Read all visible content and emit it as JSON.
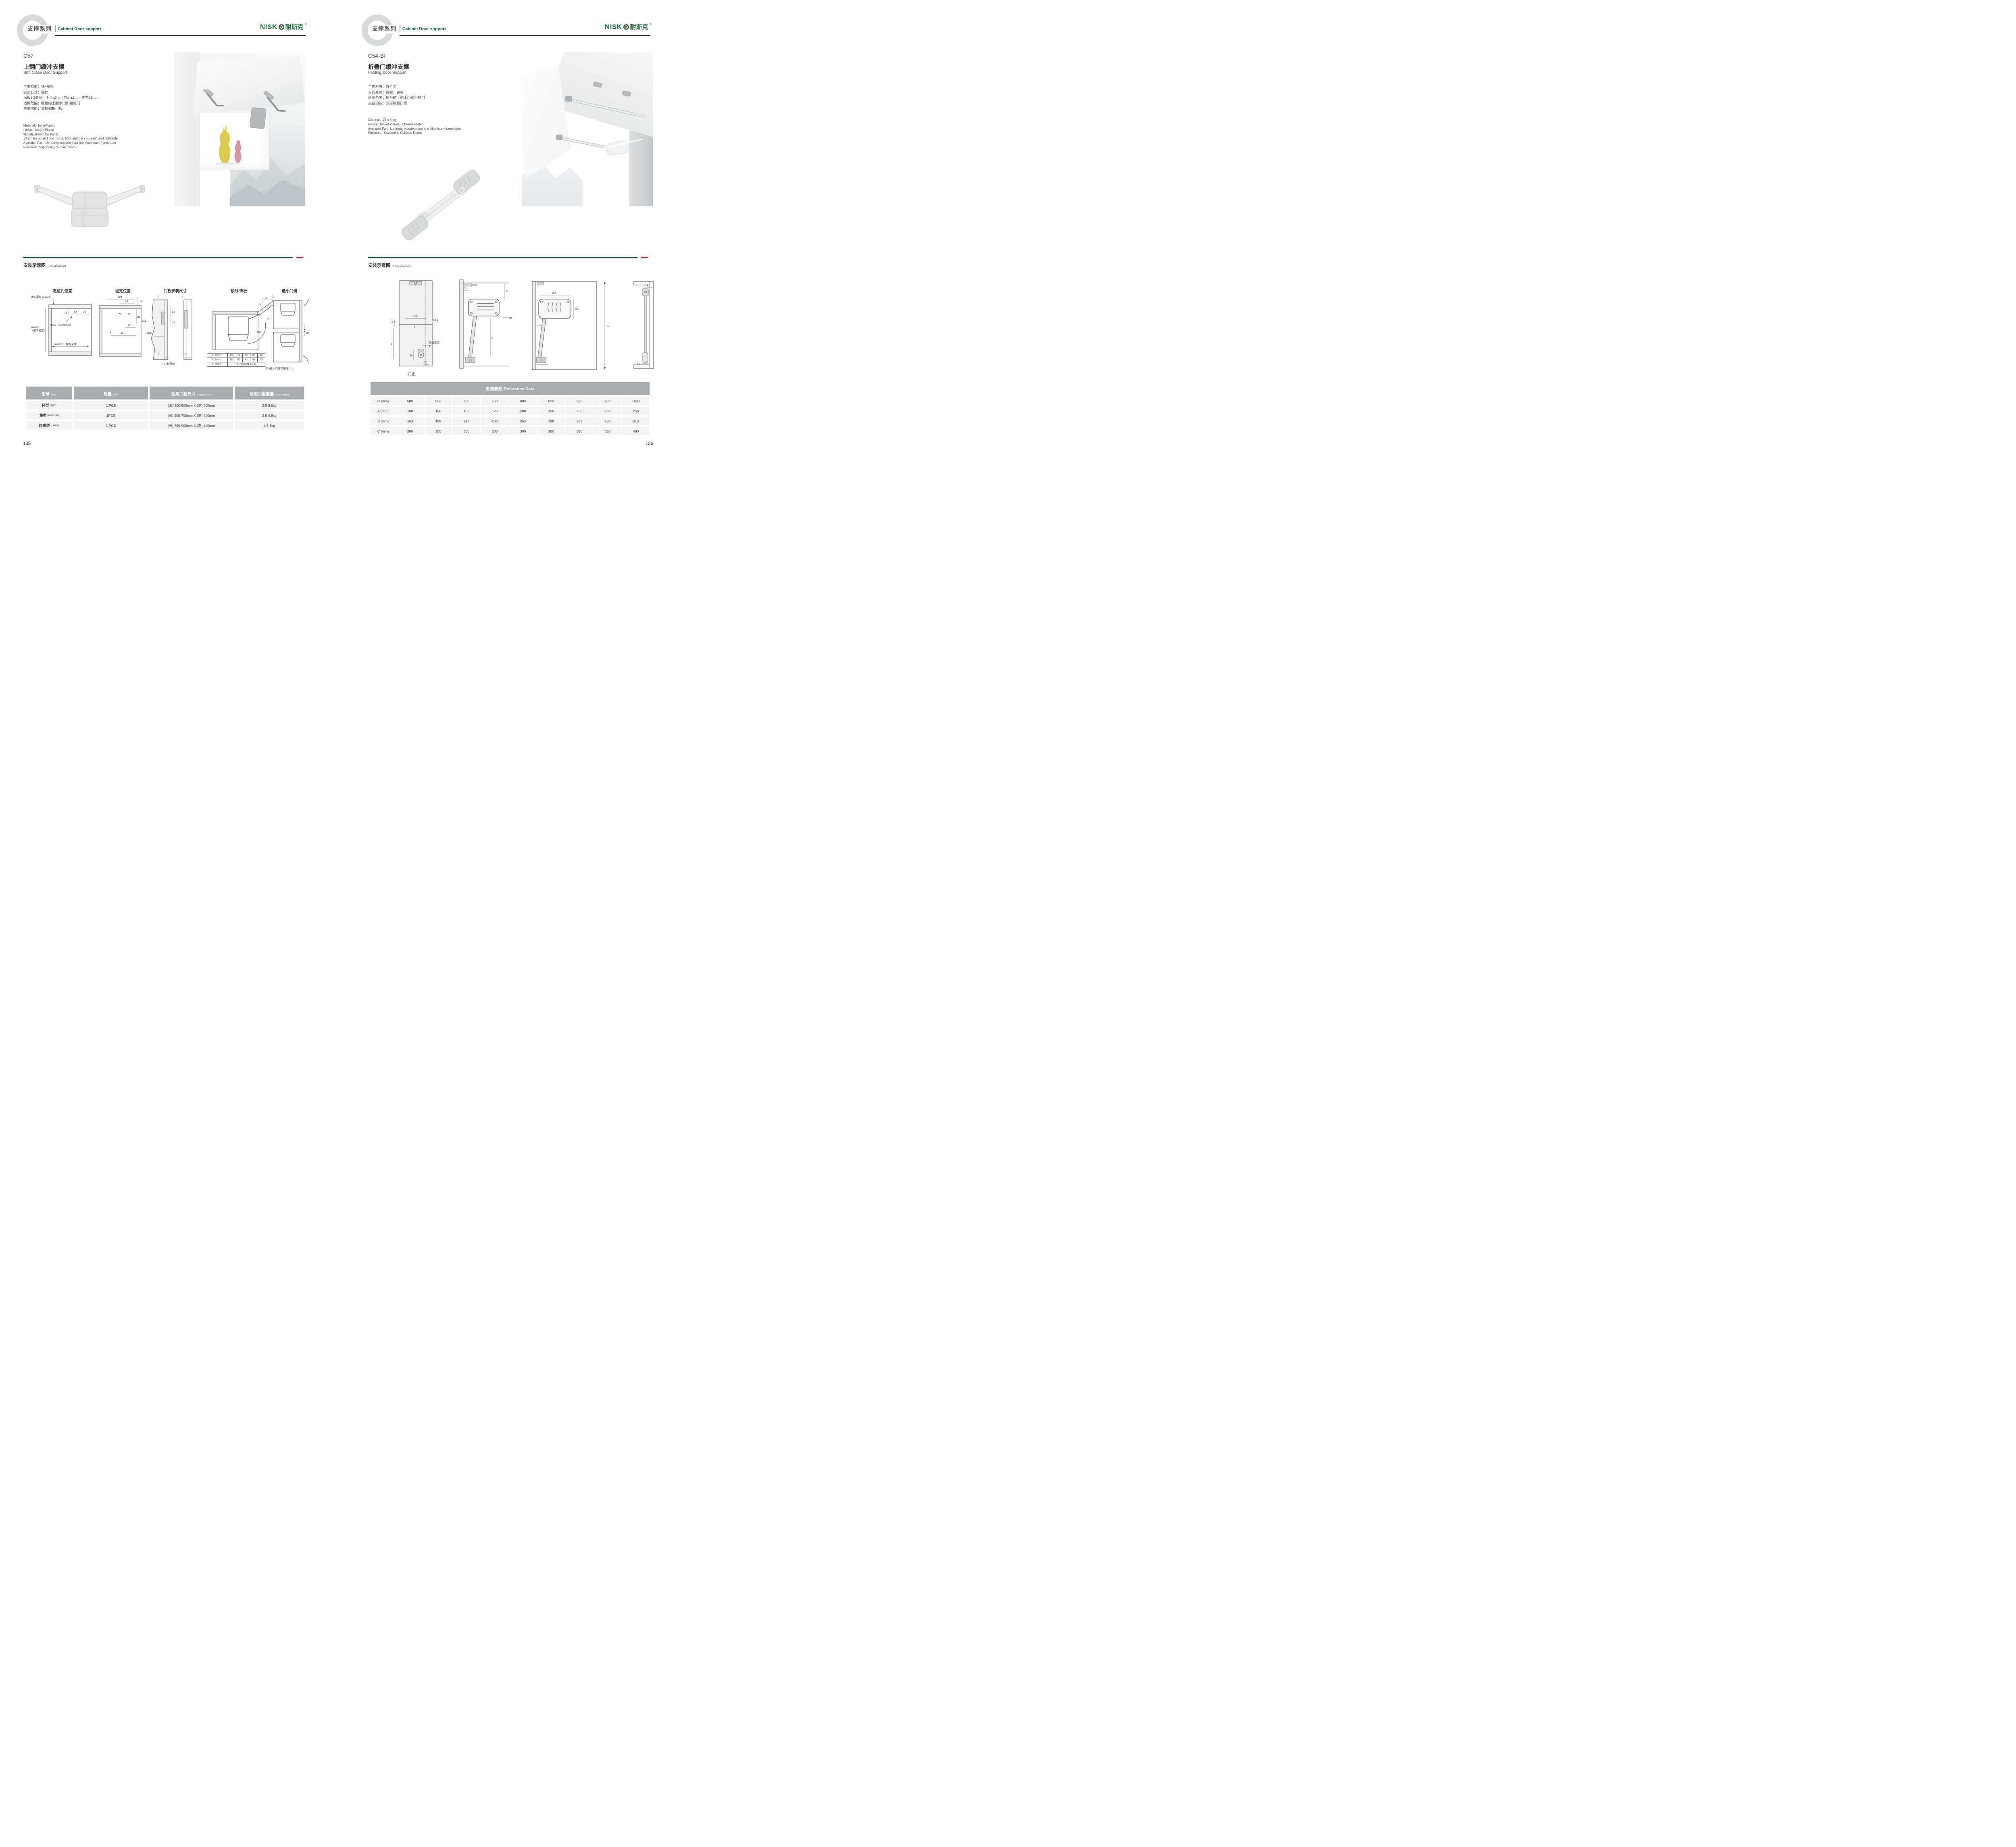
{
  "theme": {
    "brand_green": "#1a6b3f",
    "divider_green": "#17523b",
    "accent_red": "#c2242e",
    "table_header_gray": "#a8abad",
    "row_gray": "#f3f3f4"
  },
  "header": {
    "series_zh": "支撑系列",
    "series_en": "Cabinet Door support",
    "logo_latin": "NISK",
    "logo_zh": "耐斯克",
    "logo_reg": "®"
  },
  "install_heading": {
    "zh": "安装示意图",
    "en": "Installation"
  },
  "pages": [
    {
      "page_number": "135",
      "product": {
        "code": "C57",
        "title_zh": "上翻门缓冲支撑",
        "title_en": "Soft Close Door Support",
        "specs_zh": [
          "主要材质：铁+塑料",
          "表面处理：镀镍",
          "面板3D调节：上下±2mm,前后±2mm,左右±2mm",
          "适用范围：橱柜的上翻木门和铝框门",
          "主要功能：支撑橱柜门板"
        ],
        "specs_en": [
          "Material：Iron+Plastic",
          "Finish：Nickel Plated",
          "3D adjustment for Panel：",
          "±2mm for up and down side, front and back side,left and right side",
          "Available For：Up-turnig wooden door and Aluminum-frame door",
          "Function：Supoorting Cabined Doors"
        ]
      },
      "diagrams": {
        "d1": {
          "title": "定位孔位置",
          "top_thickness": "顶板厚度 max22",
          "h49": "49",
          "h64": "64",
          "h36": "36",
          "hole": "Φ5.2（深度5mm）",
          "min200": "min200",
          "min200b": "（柜内高度）",
          "min230": "min230（柜内深度）"
        },
        "d2": {
          "title": "固定位置",
          "d124": "124",
          "d52": "52",
          "d12": "12",
          "d81": "81",
          "d115": "115",
          "d42": "42",
          "d146": "146"
        },
        "d3": {
          "title": "门板安装尺寸",
          "t1": "T",
          "d53": "53",
          "d32": "32",
          "d125": "12.5",
          "t2": "T",
          "t3": "T",
          "t4": "T",
          "caption": "T=门板厚度"
        },
        "d4": {
          "title": "顶线/饰板",
          "y": "Y",
          "x": "X",
          "d": "D",
          "fh": "FH",
          "angle": "110°",
          "table": {
            "r1": [
              "D（mm）",
              "16",
              "18",
              "22",
              "26",
              "28"
            ],
            "r2": [
              "X（mm）",
              "55",
              "50",
              "42",
              "34",
              "29"
            ],
            "r3_label": "Y（mm）",
            "r3_value": "Y=FHx0.31-15+D"
          }
        },
        "d5": {
          "title": "最小门缝",
          "mf": "MF",
          "caption": "Fm最小门缝开启时2mm"
        }
      },
      "table": {
        "headers": [
          {
            "zh": "型号",
            "en": "Type"
          },
          {
            "zh": "数量",
            "en": "QTY"
          },
          {
            "zh": "适用门板尺寸",
            "en": "Cabinet size"
          },
          {
            "zh": "适用门板重量",
            "en": "Door weight"
          }
        ],
        "rows": [
          {
            "type_zh": "轻型",
            "type_en": "(light)",
            "qty": "1 PCS",
            "size": "(长) 300-500mm X (高) 400mm",
            "weight": "2.5-3.5kg"
          },
          {
            "type_zh": "重型",
            "type_en": "(Medium)",
            "qty": "1PCS",
            "size": "(长) 500-700mm X (高) 400mm",
            "weight": "3.5-4.8kg"
          },
          {
            "type_zh": "超重型",
            "type_en": "(Large)",
            "qty": "1 PCS",
            "size": "(长) 700-900mm X (高) 400mm",
            "weight": "4.8-6kg"
          }
        ]
      }
    },
    {
      "page_number": "136",
      "product": {
        "code": "C54-BI",
        "title_zh": "折叠门缓冲支撑",
        "title_en": "Folding Door Support",
        "specs_zh": [
          "主要材质：锌合金",
          "表面处理：镀镍、镀铬",
          "适用范围：橱柜的上翻木门和铝框门",
          "主要功能：支撑橱柜门板"
        ],
        "specs_en": [
          "Material：Zinc Alloy",
          "Finish：Nickel Plated、Chrome Plated",
          "Available For：Up-turnig wooden door and Aluminum-frame door",
          "Function：Supoorting Cabined Doors"
        ]
      },
      "diagrams": {
        "d1": {
          "d135": "135",
          "d145l": "14.5",
          "d145r": "14.5",
          "b": "B",
          "side": "侧板厚度",
          "d54": "54",
          "d12": "12",
          "caption": "门板"
        },
        "d2": {
          "d5": "5",
          "a": "A",
          "d19": "19",
          "c": "C"
        },
        "d3": {
          "d193": "193",
          "d102": "102",
          "d23": "23",
          "h": "H",
          "d50": "50"
        },
        "d4": {
          "d24": "24",
          "d12": "12"
        }
      },
      "reference_table": {
        "title": "安装参数 Reference Data",
        "rows": [
          {
            "label": "H (mm)",
            "values": [
              "600",
              "650",
              "700",
              "750",
              "800",
              "850",
              "900",
              "950",
              "1000"
            ]
          },
          {
            "label": "A (mm)",
            "values": [
              "100",
              "150",
              "100",
              "120",
              "200",
              "250",
              "200",
              "250",
              "250"
            ]
          },
          {
            "label": "B (mm)",
            "values": [
              "163",
              "188",
              "213",
              "208",
              "263",
              "288",
              "263",
              "288",
              "313"
            ]
          },
          {
            "label": "C (mm)",
            "values": [
              "200",
              "200",
              "300",
              "300",
              "300",
              "300",
              "350",
              "350",
              "400"
            ]
          }
        ]
      }
    }
  ]
}
